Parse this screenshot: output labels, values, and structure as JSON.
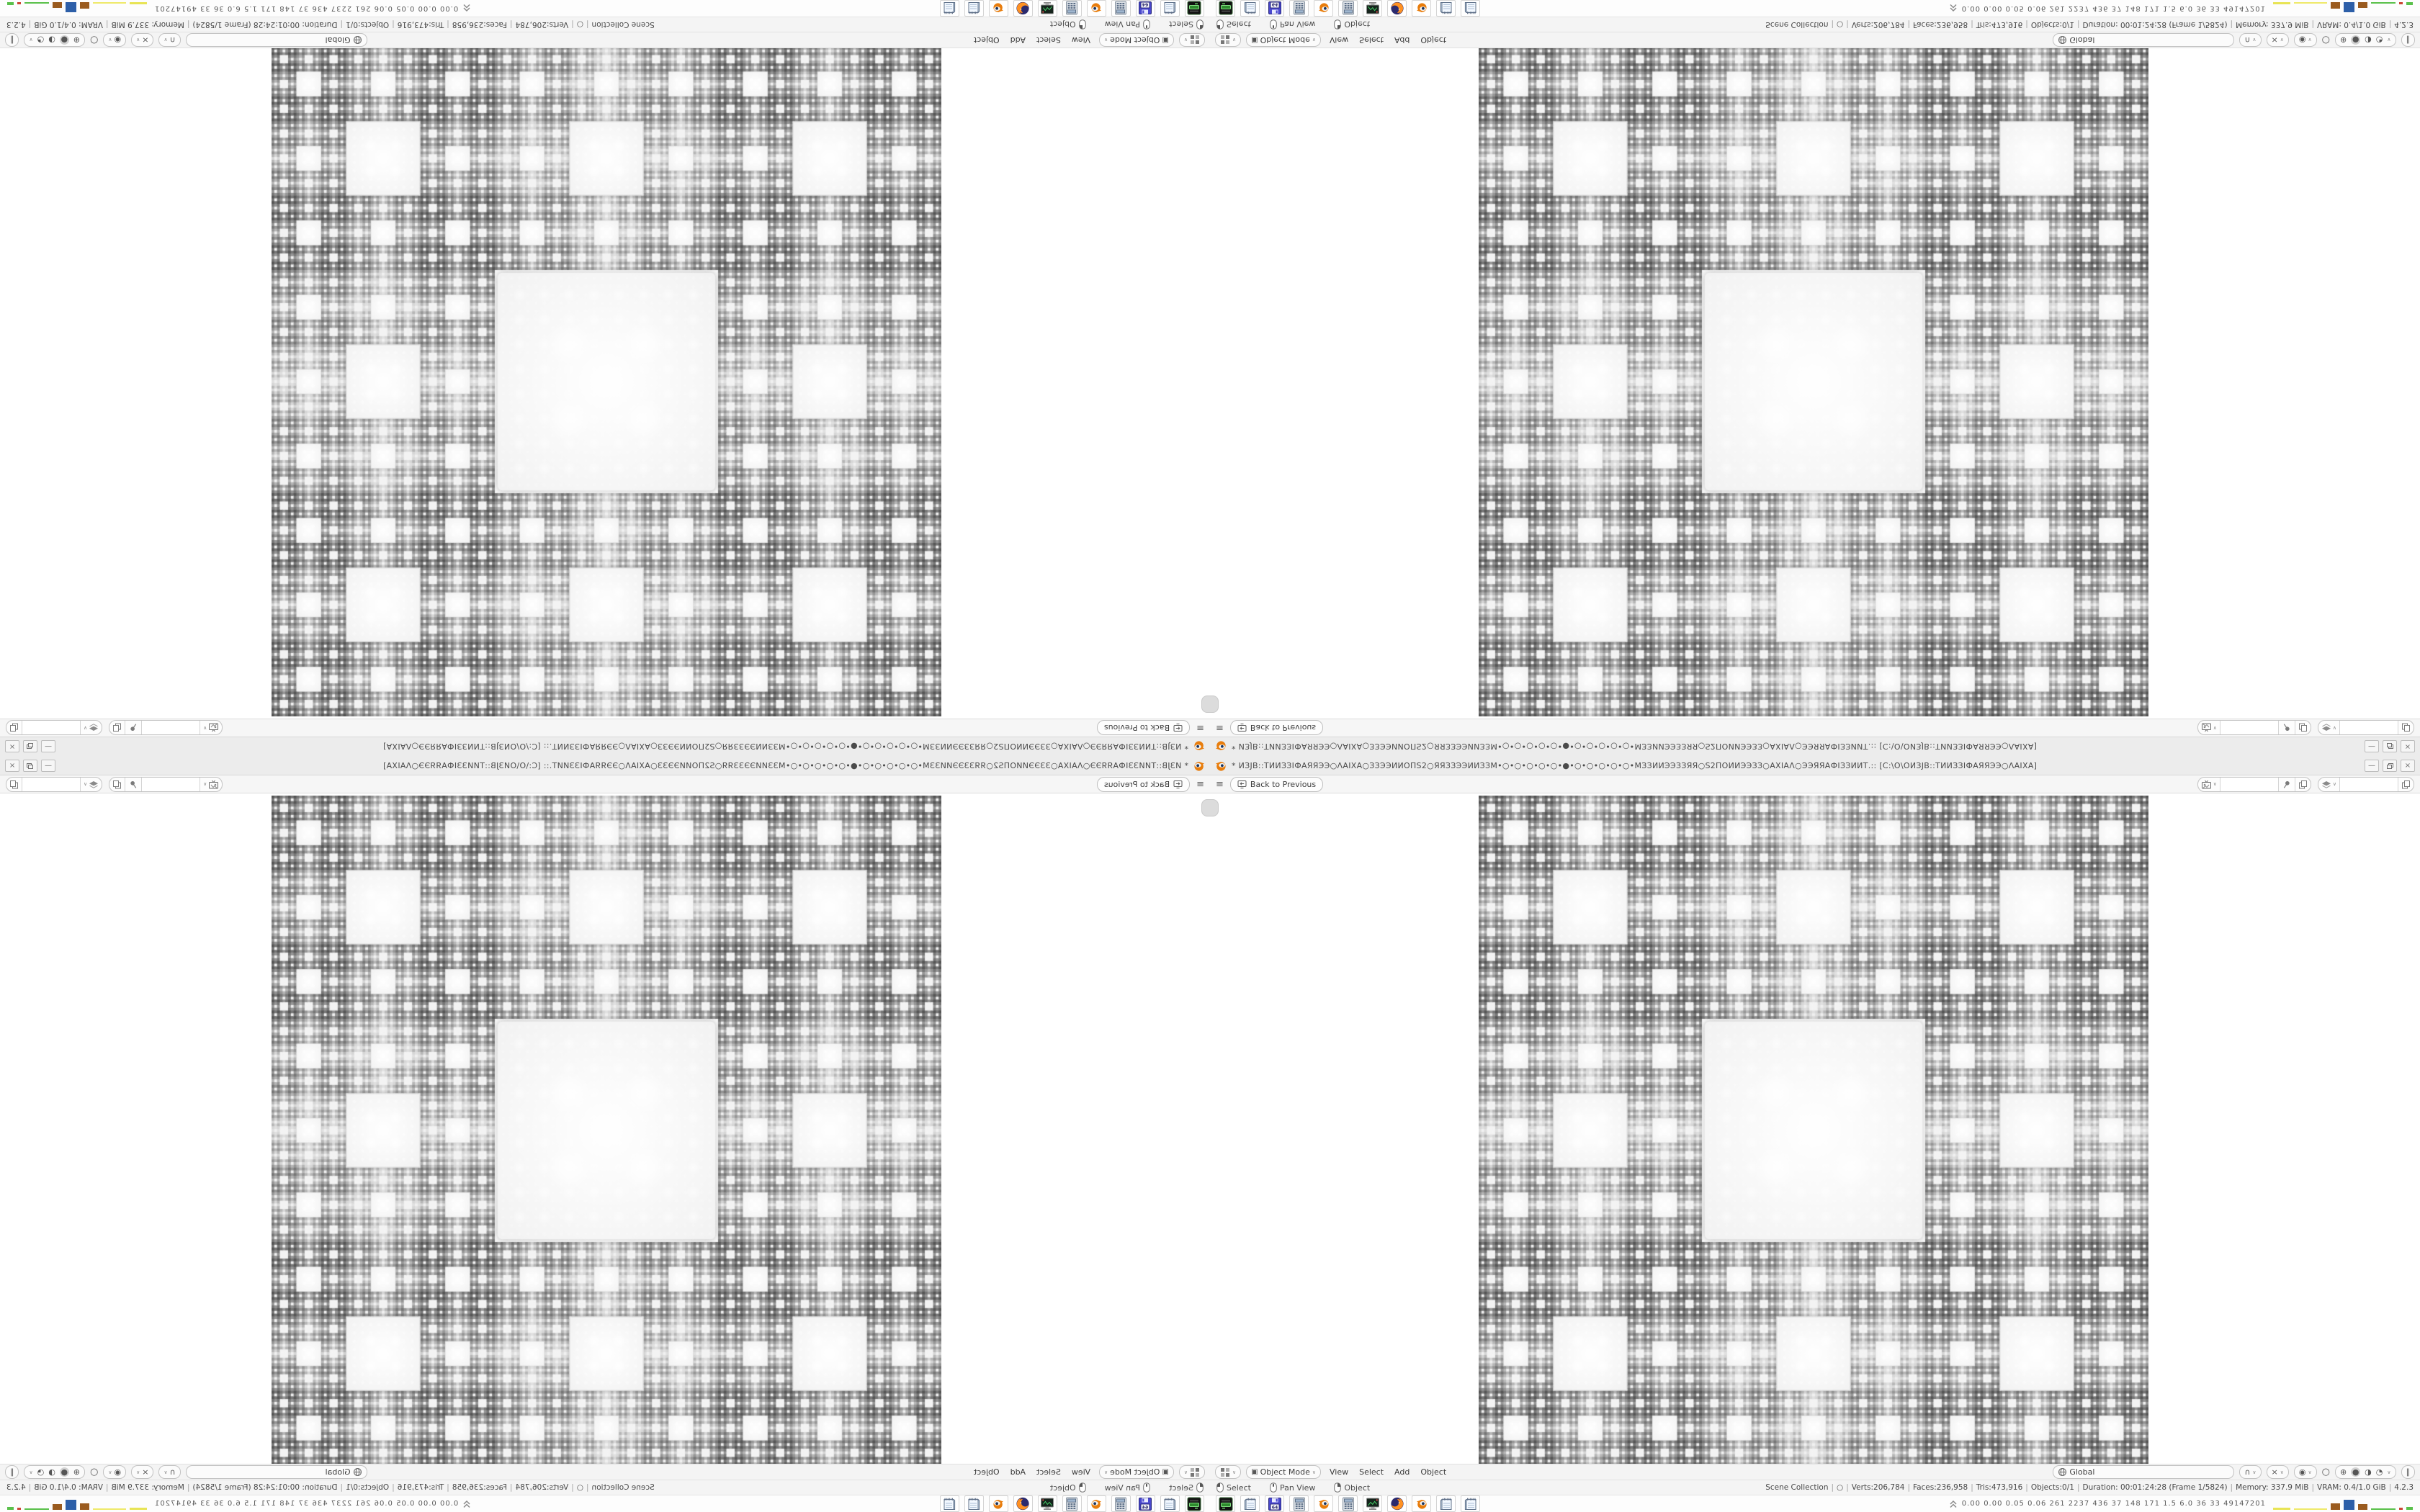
{
  "window": {
    "title": "* ИЗЈВ::ТИИЗЗІФАЯЯЭЭ○ΛАІХА○ЗЗЭЭИИОПЅ2○ЯЯЗЗЭЭИИЗЗМ•○•○•○•○•○•●•○•○•○•○•○•МЗЗИИЭЭЗЗЯЯ○Ѕ2ПОИИЭЭЗЗ○АХІАΛ○ЭЭЯЯАФІЗЗИИТ.:: [С:\\О\\ОИЗЈВ::ТИИЗЗІФАЯЯЭЭ○ΛАІХА]",
    "minimize_glyph": "—",
    "close_glyph": "×"
  },
  "topbar": {
    "menu_glyph": "≡",
    "back_label": "Back to Previous"
  },
  "header": {
    "mode_icon_glyph": "▣",
    "mode_label": "Object Mode",
    "menus": [
      "View",
      "Select",
      "Add",
      "Object"
    ],
    "orientation_label": "Global",
    "snap_glyph": "∩",
    "proportional_glyph": "×",
    "gizmo_glyph": "◉",
    "overlay_glyph": "○",
    "shading_wireframe_glyph": "⊕",
    "shading_solid_glyph": "●",
    "shading_material_glyph": "◑",
    "shading_rendered_glyph": "◔",
    "xray_glyph": "∥",
    "chevron_glyph": "∨"
  },
  "statusbar": {
    "hints": [
      {
        "button": "left",
        "label": "Select"
      },
      {
        "button": "middle",
        "label": "Pan View"
      },
      {
        "button": "right",
        "label": "Object"
      }
    ],
    "stats": [
      "Scene Collection",
      "○",
      "Verts:206,784",
      "Faces:236,958",
      "Tris:473,916",
      "Objects:0/1",
      "Duration: 00:01:24:28 (Frame 1/5824)",
      "Memory: 337.9 MiB",
      "VRAM: 0.4/1.0 GiB",
      "4.2.3"
    ]
  },
  "taskbar": {
    "icons": [
      "drive",
      "notepad",
      "floppy64",
      "calculator",
      "blender",
      "calculator",
      "screenshot",
      "firefox",
      "blender",
      "notepad",
      "notepad"
    ],
    "monitor": {
      "values": "0.00 0.00 0.05 0.06 261 2237 436 37 148 171 1.5 6.0 36 33 49147201",
      "bars": [
        {
          "color": "#e8e455",
          "w": 24,
          "h": 3
        },
        {
          "color": "#efe96a",
          "w": 46,
          "h": 2
        },
        {
          "color": "#9a5b1f",
          "w": 13,
          "h": 9
        },
        {
          "color": "#2d5fa8",
          "w": 15,
          "h": 14
        },
        {
          "color": "#9a5b1f",
          "w": 13,
          "h": 8
        },
        {
          "color": "#59c04a",
          "w": 34,
          "h": 2
        },
        {
          "color": "#cc4433",
          "w": 5,
          "h": 3
        },
        {
          "color": "#59c04a",
          "w": 9,
          "h": 4
        }
      ]
    }
  },
  "colors": {
    "accent": "#e87d0d",
    "chrome": "#ececec",
    "viewport_bg": "#ffffff"
  }
}
